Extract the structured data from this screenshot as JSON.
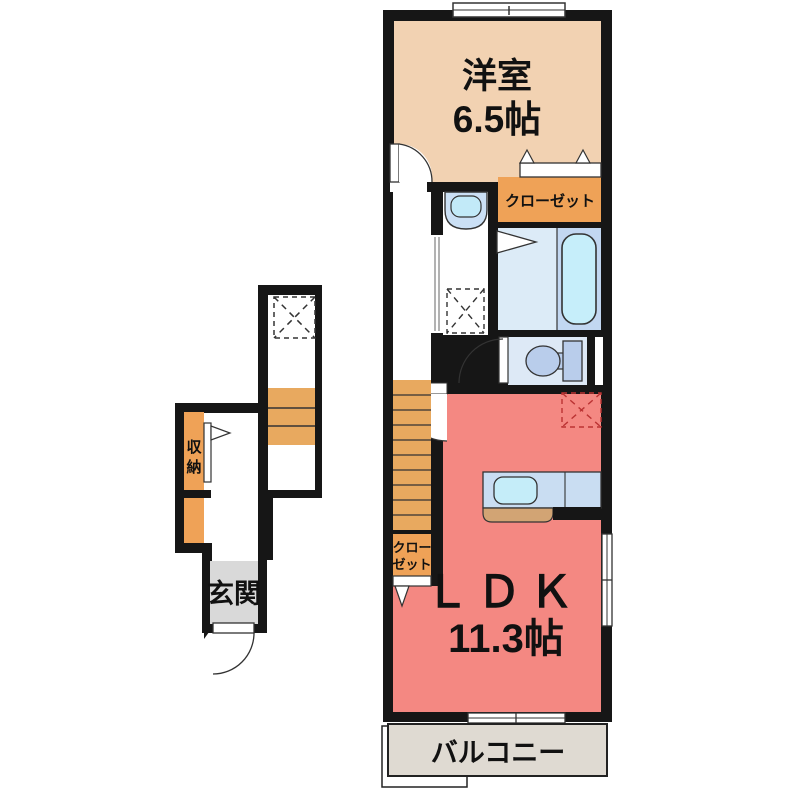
{
  "plan": {
    "floor_2f": {
      "western_room": {
        "label": "洋室",
        "area": "6.5帖"
      },
      "closet": {
        "label": "クローゼット"
      },
      "stair_closet": {
        "line1": "クロー",
        "line2": "ゼット"
      },
      "ldk": {
        "label": "ＬＤＫ",
        "area": "11.3帖"
      },
      "balcony": {
        "label": "バルコニー"
      }
    },
    "floor_1f": {
      "entrance": {
        "label": "玄関"
      },
      "storage": {
        "line1": "収",
        "line2": "納"
      }
    }
  },
  "colors": {
    "wall": "#161616",
    "western_room": "#f2d2b2",
    "closet_orange": "#efa257",
    "stairs": "#e8a95f",
    "ldk": "#f48882",
    "bath_floor": "#dcebf7",
    "bathtub_zone": "#c2d7f1",
    "bathtub": "#c6eefa",
    "toilet_floor": "#dde9f6",
    "fixture_blue": "#b9cdeb",
    "vanity": "#cbe0f5",
    "vanity_basin": "#c2eaf8",
    "kitchen_counter": "#c9ddf2",
    "sink": "#c5edf9",
    "kitchen_wood": "#d2a474",
    "entrance_gray": "#d9d9d9",
    "balcony": "#dfdad2"
  }
}
